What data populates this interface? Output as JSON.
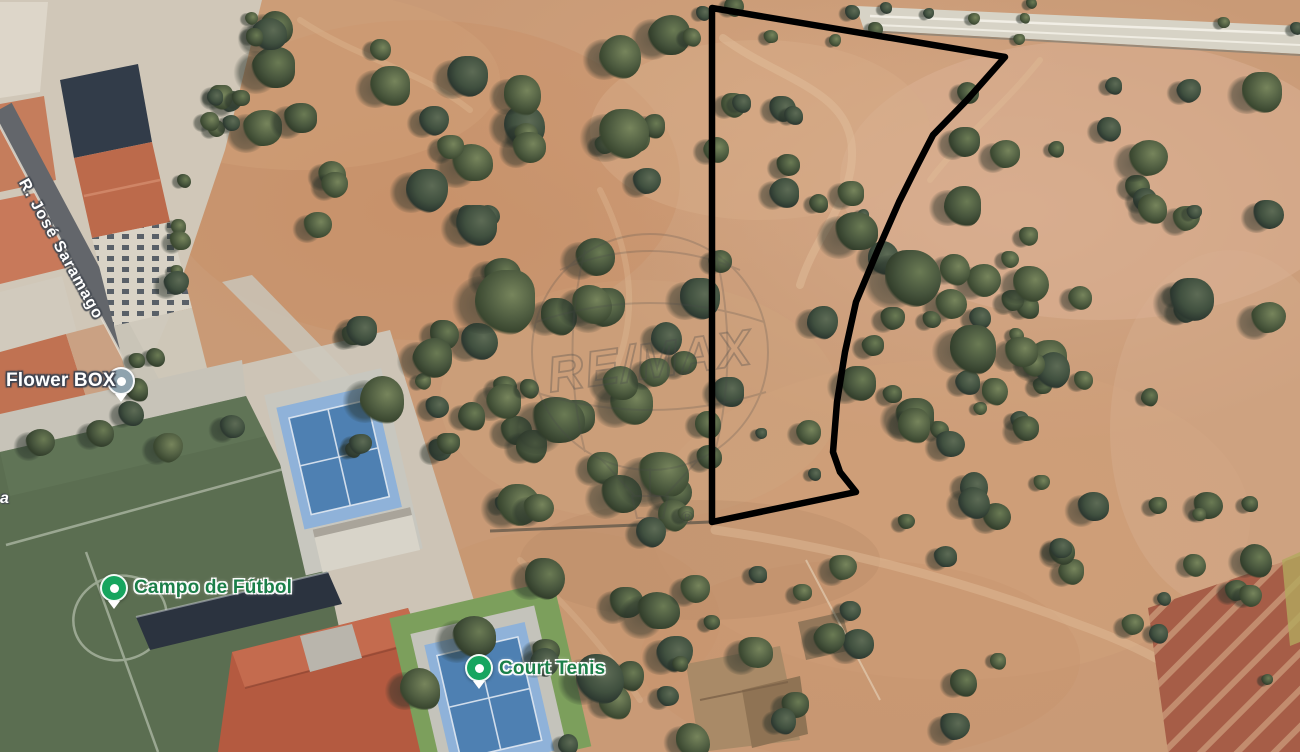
{
  "map": {
    "street_label": "R. José Saramago",
    "edge_label": "a",
    "pois": [
      {
        "id": "flower-box",
        "name": "Flower BOX",
        "pin_color": "#8fa3ae",
        "text_color": "#ffffff"
      },
      {
        "id": "campo-de-futbol",
        "name": "Campo de Fútbol",
        "pin_color": "#17a55f",
        "text_color": "#1b7f49"
      },
      {
        "id": "court-tenis",
        "name": "Court Tenis",
        "pin_color": "#17a55f",
        "text_color": "#1b7f49"
      }
    ],
    "watermark": {
      "brand": "RE/MAX",
      "registered": "®"
    },
    "parcel_outline": {
      "color": "#000000",
      "stroke_width": 6.5,
      "points": [
        [
          712,
          8
        ],
        [
          1005,
          57
        ],
        [
          967,
          100
        ],
        [
          933,
          135
        ],
        [
          916,
          168
        ],
        [
          899,
          202
        ],
        [
          877,
          252
        ],
        [
          856,
          302
        ],
        [
          845,
          352
        ],
        [
          837,
          402
        ],
        [
          833,
          452
        ],
        [
          840,
          472
        ],
        [
          856,
          492
        ],
        [
          712,
          522
        ]
      ]
    }
  }
}
